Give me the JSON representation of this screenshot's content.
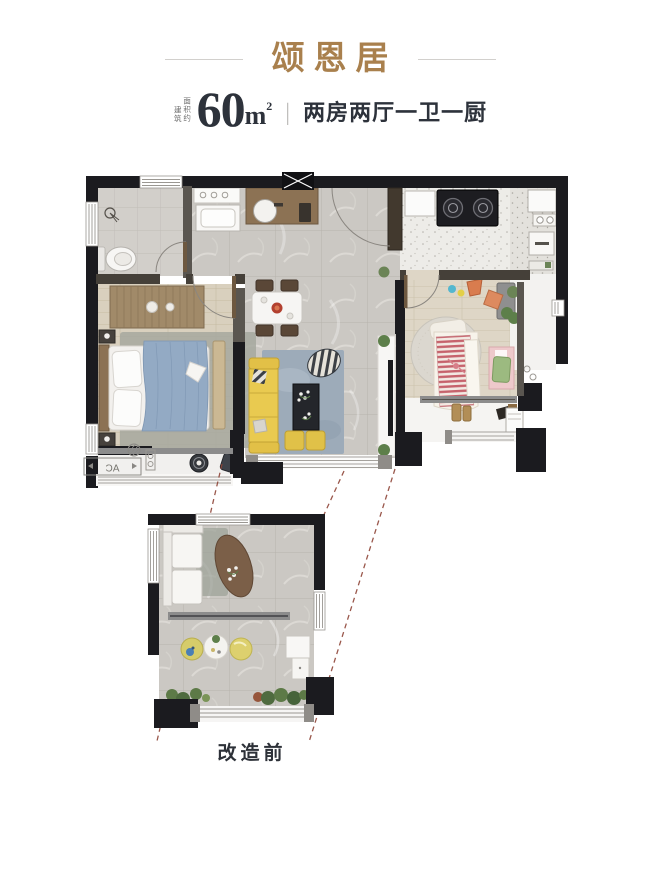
{
  "header": {
    "title": "颂恩居",
    "area_prefix_col1": "建筑",
    "area_prefix_col2": "面积约",
    "area_value": "60",
    "area_unit_m": "m",
    "area_unit_sup": "2",
    "divider": "|",
    "layout_text": "两房两厅一卫一厨"
  },
  "plan": {
    "ac_label": "AC",
    "before_label": "改造前"
  },
  "colors": {
    "accent_gold": "#a9804d",
    "text_dark": "#2d323b",
    "wall_black": "#1b1b1f",
    "sofa_yellow": "#e8c84a",
    "duvet_blue": "#92a9c4",
    "bed2_stripe_red": "#c6636c",
    "leader_line_red": "#8f4538"
  }
}
